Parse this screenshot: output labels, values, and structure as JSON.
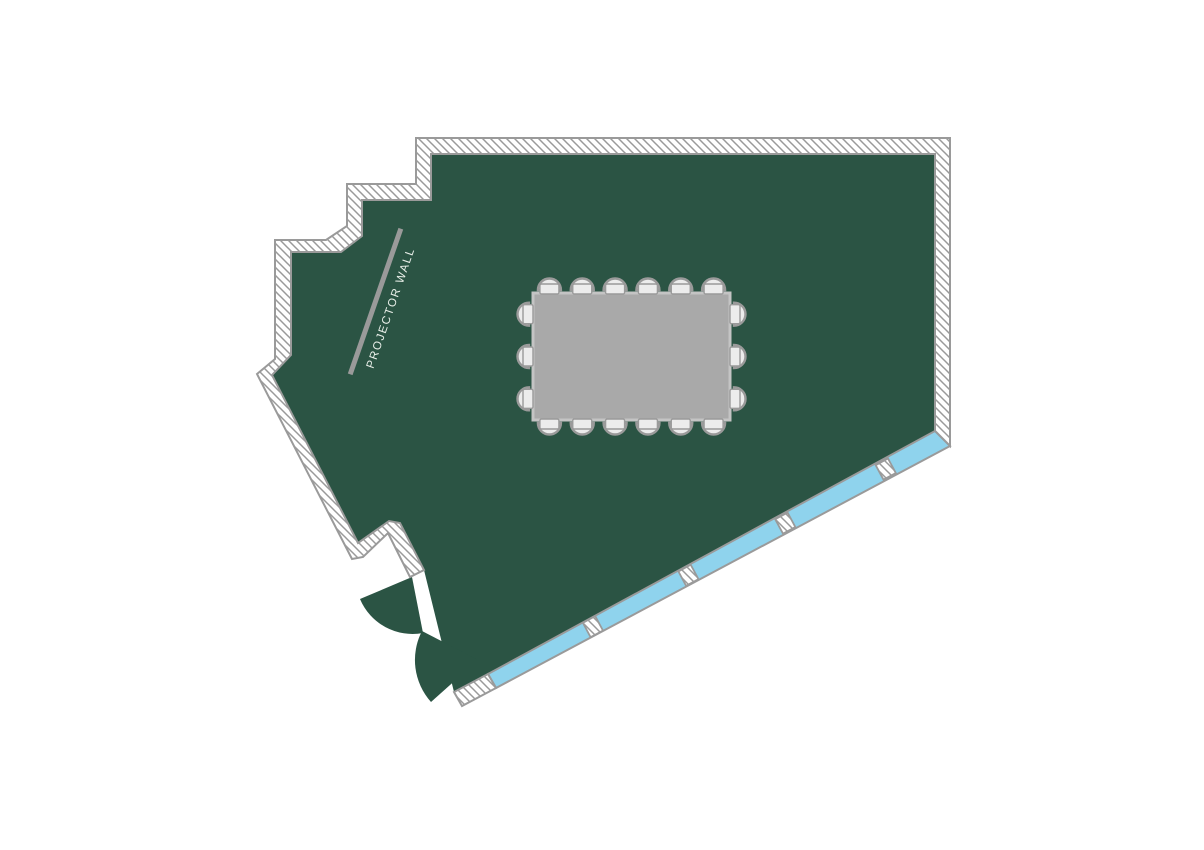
{
  "floorplan": {
    "projector_wall_label": "PROJECTOR WALL",
    "colors": {
      "floor": "#2b5444",
      "window": "#8fd3ed",
      "wall_line": "#9a9a9a",
      "wall_fill": "#ffffff",
      "table": "#a9a9a9",
      "table_border": "#c4c4c4",
      "chair_fill": "#ececec",
      "label_text": "#e9efe9"
    },
    "table": {
      "x": 533,
      "y": 293,
      "width": 197,
      "height": 127
    },
    "chairs": {
      "top": 6,
      "bottom": 6,
      "left": 3,
      "right": 3,
      "total": 18
    },
    "window": {
      "mullion_fractions": [
        0.224,
        0.436,
        0.651,
        0.874
      ]
    },
    "doors": {
      "count": 2
    }
  }
}
